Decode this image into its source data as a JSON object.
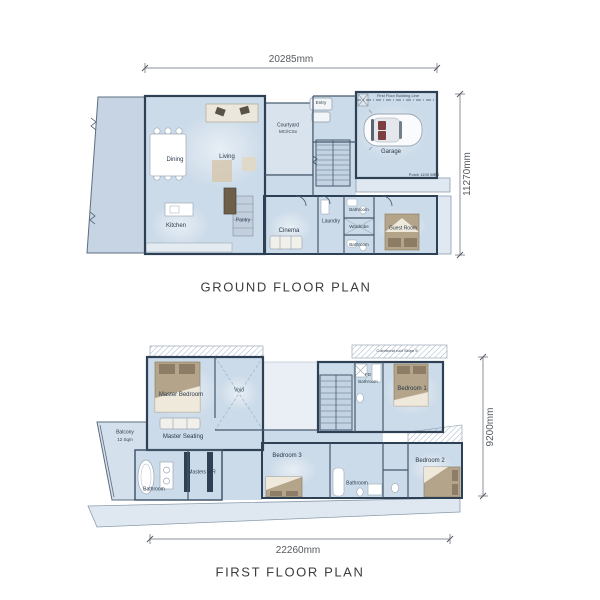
{
  "ground": {
    "title": "GROUND FLOOR PLAN",
    "dim_width": "20285mm",
    "dim_height": "11270mm",
    "annotations": {
      "building_line": "First Floor Building Line",
      "porch": "Porch 1100 WBS",
      "courtyard_area": "MC/ICSx"
    },
    "rooms": {
      "dining": "Dining",
      "living": "Living",
      "kitchen": "Kitchen",
      "pantry": "Pantry",
      "courtyard": "Courtyard",
      "entry": "Entry",
      "garage": "Garage",
      "cinema": "Cinema",
      "laundry": "Laundry",
      "bathroom_top": "Bathroom",
      "wardrobe": "Wardrobe",
      "bathroom_bottom": "Bathroom",
      "guest_room": "Guest Room"
    }
  },
  "first": {
    "title": "FIRST FLOOR PLAN",
    "dim_width": "22260mm",
    "dim_height": "9200mm",
    "annotations": {
      "roof_note": "Colorbond roof Slope 5",
      "balcony_area": "12 Sqm",
      "fd_prefix": "FD"
    },
    "rooms": {
      "master_bedroom": "Master Bedroom",
      "master_seating": "Master Seating",
      "void": "Void",
      "balcony": "Balcony",
      "master_bathroom": "Bathroom",
      "masters_wr": "Masters WR",
      "fd_bathroom": "Bathroom",
      "bedroom1": "Bedroom 1",
      "bedroom2": "Bedroom 2",
      "bedroom3": "Bedroom 3",
      "bathroom": "Bathroom"
    }
  },
  "colors": {
    "wall": "#2e4154",
    "room_fill": "#ccdbe9",
    "outdoor_fill": "#d8e3ee",
    "furniture_tan": "#b3a48a"
  }
}
